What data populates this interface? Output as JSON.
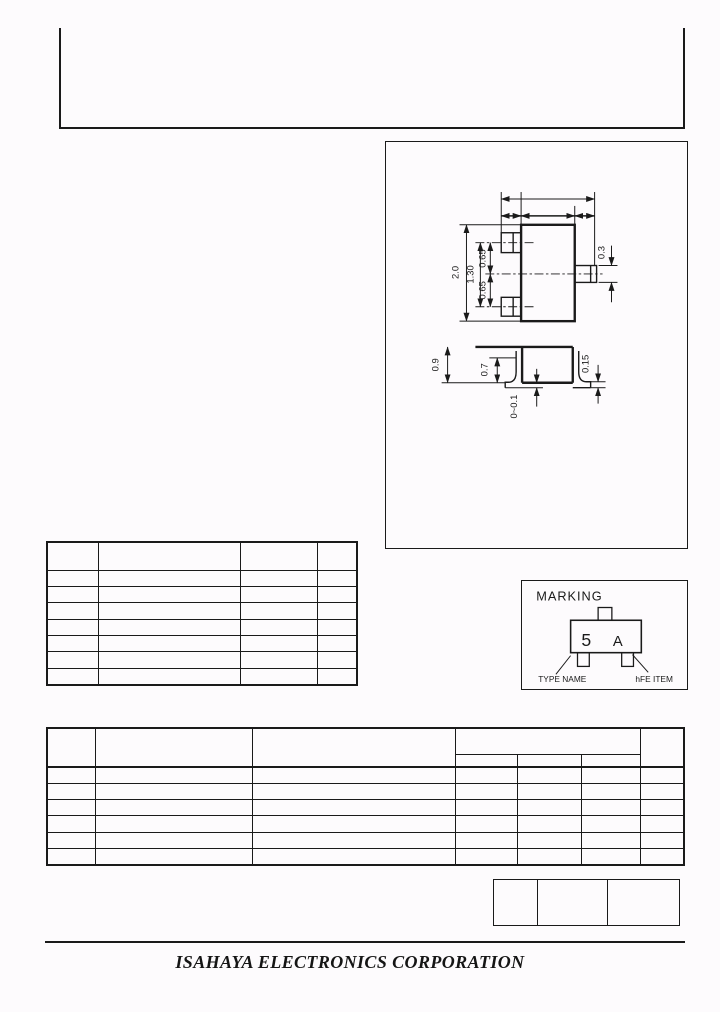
{
  "colors": {
    "paper": "#fdfbfd",
    "ink": "#1a1a1a"
  },
  "footer": {
    "company": "ISAHAYA ELECTRONICS CORPORATION"
  },
  "marking": {
    "title": "MARKING",
    "type_code": "5",
    "hfe_code": "A",
    "label_left": "TYPE NAME",
    "label_right": "hFE ITEM"
  },
  "package_drawing": {
    "top_view": {
      "dim_overall_height": "2.0",
      "dim_lead_span": "1.30",
      "dim_pitch_upper": "0.65",
      "dim_pitch_lower": "0.65",
      "dim_lead_width": "0.3"
    },
    "side_view": {
      "dim_body_height": "0.9",
      "dim_lead_height": "0.7",
      "dim_standoff": "0~0.1",
      "dim_lead_thickness": "0.15"
    }
  },
  "tables": {
    "parameter_table": {
      "columns": 4,
      "header_rows": 1,
      "data_rows": 7
    },
    "ratings_table": {
      "columns": 7,
      "group_subcolumns": 3,
      "data_rows": 6
    },
    "revision_table": {
      "cells": 3
    }
  }
}
